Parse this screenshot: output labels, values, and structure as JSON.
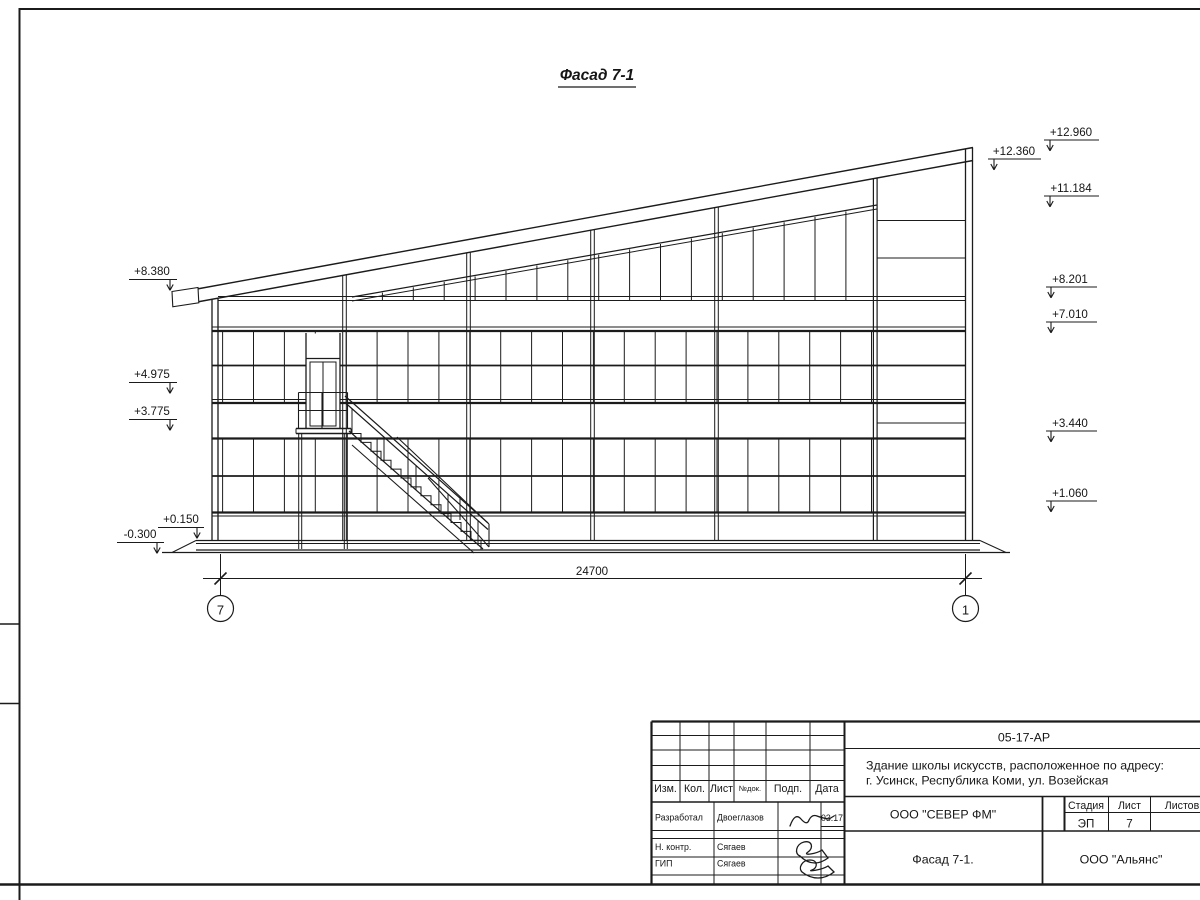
{
  "drawing": {
    "view_title": "Фасад 7-1",
    "total_dimension": "24700",
    "axes": {
      "left": "7",
      "right": "1"
    },
    "elevation_marks_left": [
      {
        "label": "+8.380"
      },
      {
        "label": "+4.975"
      },
      {
        "label": "+3.775"
      },
      {
        "label": "+0.150"
      },
      {
        "label": "-0.300"
      }
    ],
    "elevation_marks_right": [
      {
        "label": "+12.960"
      },
      {
        "label": "+12.360"
      },
      {
        "label": "+11.184"
      },
      {
        "label": "+8.201"
      },
      {
        "label": "+7.010"
      },
      {
        "label": "+3.440"
      },
      {
        "label": "+1.060"
      }
    ]
  },
  "title_block": {
    "doc_number": "05-17-АР",
    "project_line1": "Здание школы искусств, расположенное по адресу:",
    "project_line2": "г. Усинск, Республика Коми, ул. Возейская",
    "columns": {
      "izm": "Изм.",
      "kol": "Кол.",
      "list": "Лист",
      "ndok": "№док.",
      "podp": "Подп.",
      "data": "Дата"
    },
    "rows": [
      {
        "role": "Разработал",
        "name": "Двоеглазов",
        "date": "03.17"
      },
      {
        "role": "Н. контр.",
        "name": "Сягаев",
        "date": ""
      },
      {
        "role": "ГИП",
        "name": "Сягаев",
        "date": ""
      }
    ],
    "stage_label": "Стадия",
    "stage_value": "ЭП",
    "sheet_label": "Лист",
    "sheet_value": "7",
    "sheets_label": "Листов",
    "org": "ООО \"СЕВЕР ФМ\"",
    "sheet_title": "Фасад 7-1.",
    "org2": "ООО \"Альянс\""
  }
}
